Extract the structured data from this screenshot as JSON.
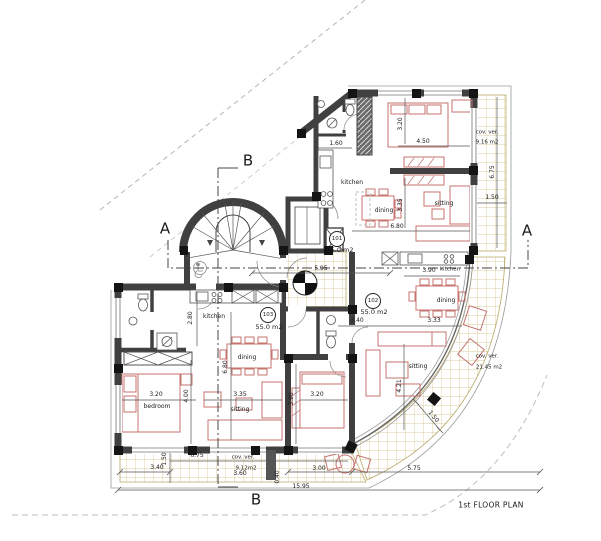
{
  "title": "1st FLOOR PLAN",
  "sections": {
    "a": "A",
    "b": "B"
  },
  "apartments": {
    "a101": {
      "number": "101",
      "area": "55.0 m2",
      "kitchen": "kitchen",
      "dining": "dining",
      "sitting": "sitting",
      "veranda_label": "cov. ver.",
      "veranda_area": "9.16 m2"
    },
    "a102": {
      "number": "102",
      "area": "55.0 m2",
      "kitchen": "kitchen",
      "dining": "dining",
      "sitting": "sitting",
      "veranda_label": "cov. ver.",
      "veranda_area": "21.45 m2"
    },
    "a103": {
      "number": "103",
      "area": "55.0 m2",
      "kitchen": "kitchen",
      "dining": "dining",
      "sitting": "sitting",
      "bedroom": "bedroom",
      "veranda_label": "cov. ver.",
      "veranda_area": "9.12m2"
    }
  },
  "dimensions": {
    "apt101": {
      "bath_w": "1.60",
      "bed_w": "3.20",
      "bed_l": "4.50",
      "din_h": "3.35",
      "liv_w": "6.80",
      "ver_h": "6.75",
      "ver_w": "1.50"
    },
    "apt102": {
      "kit_w": "3.90",
      "din_w": "3.33",
      "hall_w": "3.40",
      "sit_h": "4.21",
      "bed_w": "3.20",
      "bed_h": "3.90",
      "ver_w": "1.50"
    },
    "apt103": {
      "bath_h": "2.80",
      "liv_h": "6.80",
      "bed_w": "3.20",
      "bed_h": "4.00",
      "sit_w": "3.35"
    },
    "lobby": "5.95",
    "bottom": {
      "v340": "3.40",
      "v150": "1.50",
      "v675": "6.75",
      "v360": "3.60",
      "v040": "0.40",
      "v300": "3.00",
      "v575": "5.75",
      "total": "15.95"
    }
  },
  "colors": {
    "wall": "#404040",
    "column": "#141414",
    "furniture": "#c4736e",
    "tile": "#cdbc7c",
    "boundary": "#b5b5b5",
    "dimension": "#555555",
    "text": "#1a1a1a"
  }
}
